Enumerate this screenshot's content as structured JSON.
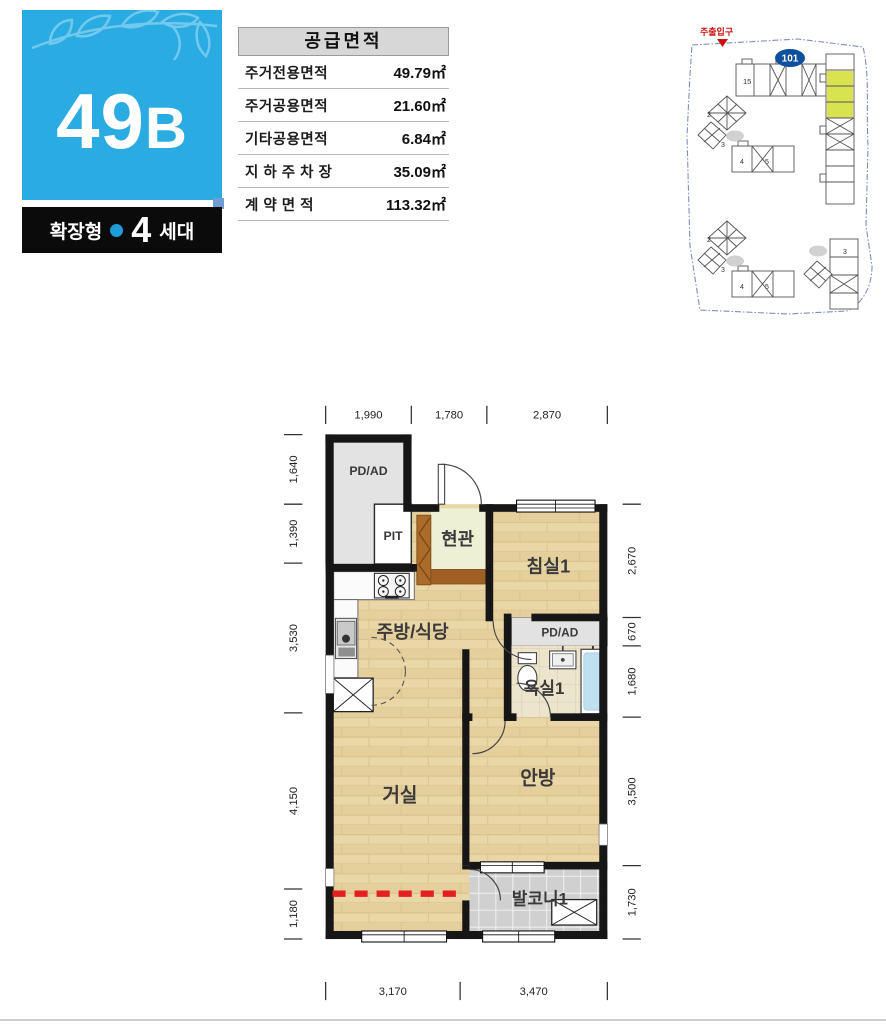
{
  "unit_badge": {
    "code_main": "49",
    "code_sub": "B",
    "bar_type": "확장형",
    "bar_count": "4",
    "bar_count_suffix": "세대"
  },
  "area_table": {
    "title": "공급면적",
    "rows": [
      {
        "label": "주거전용면적",
        "value": "49.79㎡"
      },
      {
        "label": "주거공용면적",
        "value": "21.60㎡"
      },
      {
        "label": "기타공용면적",
        "value": "6.84㎡"
      },
      {
        "label": "지 하 주 차 장",
        "value": "35.09㎡"
      },
      {
        "label": "계 약 면 적",
        "value": "113.32㎡"
      }
    ]
  },
  "site_plan": {
    "entrance_label": "주출입구",
    "highlight_badge": "101",
    "bldg_top": "15",
    "cluster_upper": [
      "2",
      "3",
      "4",
      "5"
    ],
    "cluster_lower": [
      "2",
      "3",
      "4",
      "5"
    ],
    "bldg_bottom_right": "3",
    "highlight_color": "#d8e34f"
  },
  "floor_plan": {
    "rooms": {
      "pdad_left": "PD/AD",
      "pit": "PIT",
      "entry": "현관",
      "bedroom1": "침실1",
      "kitchen": "주방/식당",
      "pdad_right": "PD/AD",
      "bath": "욕실1",
      "living": "거실",
      "master": "안방",
      "balcony": "발코니1"
    },
    "dims": {
      "top": [
        "1,990",
        "1,780",
        "2,870"
      ],
      "bottom": [
        "3,170",
        "3,470"
      ],
      "left": [
        "1,640",
        "1,390",
        "3,530",
        "4,150",
        "1,180"
      ],
      "right": [
        "2,670",
        "670",
        "1,680",
        "3,500",
        "1,730"
      ]
    },
    "extension_line_color": "#e41f1f"
  }
}
